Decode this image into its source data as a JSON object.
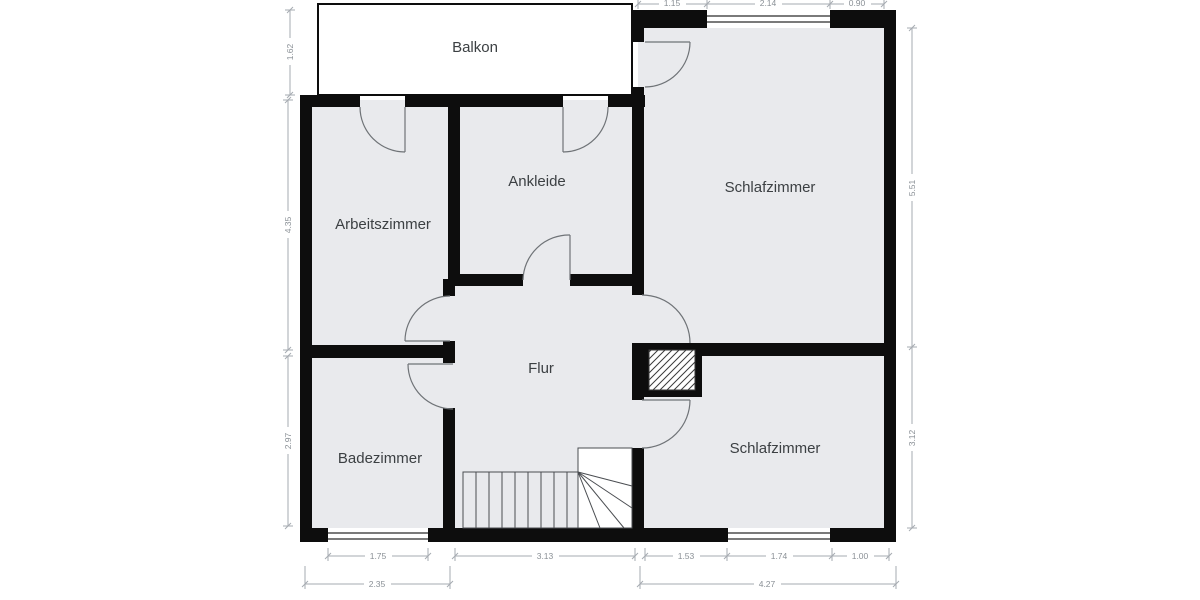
{
  "plan": {
    "type": "floor-plan",
    "rooms": [
      {
        "name": "balkon",
        "label": "Balkon"
      },
      {
        "name": "arbeitszimmer",
        "label": "Arbeitszimmer"
      },
      {
        "name": "ankleide",
        "label": "Ankleide"
      },
      {
        "name": "schlafzimmer-top",
        "label": "Schlafzimmer"
      },
      {
        "name": "flur",
        "label": "Flur"
      },
      {
        "name": "badezimmer",
        "label": "Badezimmer"
      },
      {
        "name": "schlafzimmer-bottom",
        "label": "Schlafzimmer"
      }
    ],
    "dimensions": {
      "top": [
        "1.15",
        "2.14",
        "0.90"
      ],
      "left": [
        "1.62",
        "4.35",
        "2.97"
      ],
      "right": [
        "5.51",
        "3.12"
      ],
      "bottom_inner": [
        "1.75",
        "3.13",
        "1.53",
        "1.74",
        "1.00"
      ],
      "bottom_outer": [
        "2.35",
        "4.27"
      ]
    },
    "colors": {
      "wall": "#0d0d0d",
      "floor": "#e9eaed",
      "label_text": "#3c4043",
      "dimension_text": "#8a9096",
      "balcony_fill": "#ffffff"
    }
  }
}
